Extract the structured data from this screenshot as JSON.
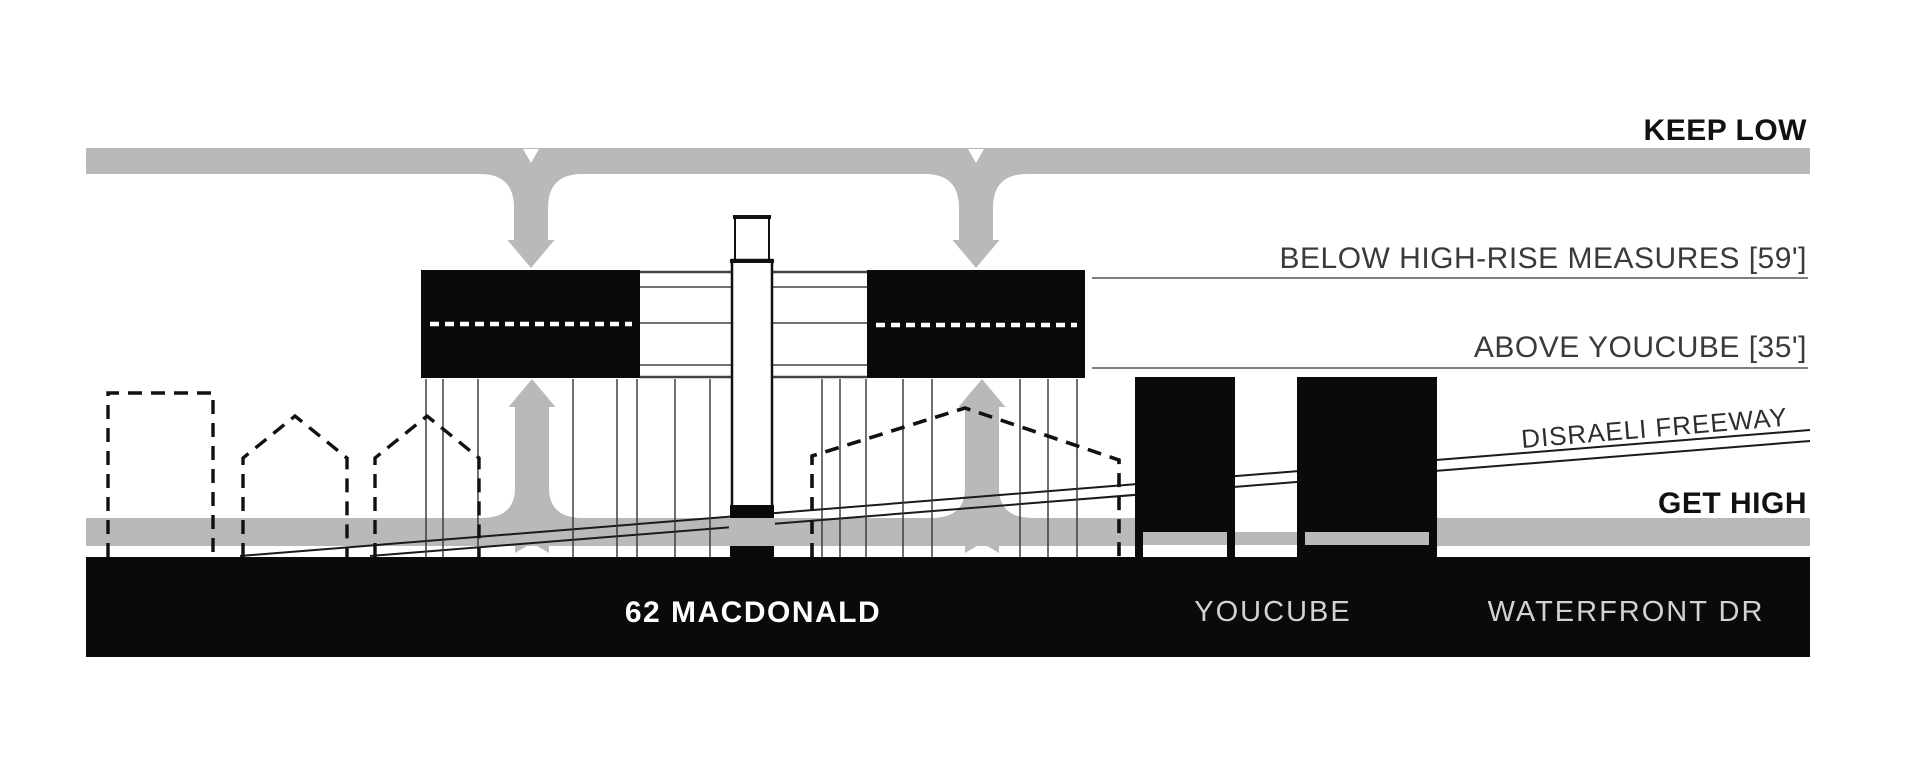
{
  "diagram": {
    "annotations": {
      "keep_low": "KEEP LOW",
      "below_highrise": "BELOW HIGH-RISE MEASURES [59']",
      "above_youcube": "ABOVE YOUCUBE [35']",
      "disraeli_freeway": "DISRAELI FREEWAY",
      "get_high": "GET HIGH"
    },
    "ground_labels": {
      "macdonald": "62 MACDONALD",
      "youcube": "YOUCUBE",
      "waterfront": "WATERFRONT DR"
    },
    "colors": {
      "band_gray": "#b9b9b9",
      "ink_black": "#0a0a0a",
      "annotation_dark": "#3a3a3a",
      "light_ground_text": "#d2d2d2",
      "background": "#ffffff"
    }
  }
}
